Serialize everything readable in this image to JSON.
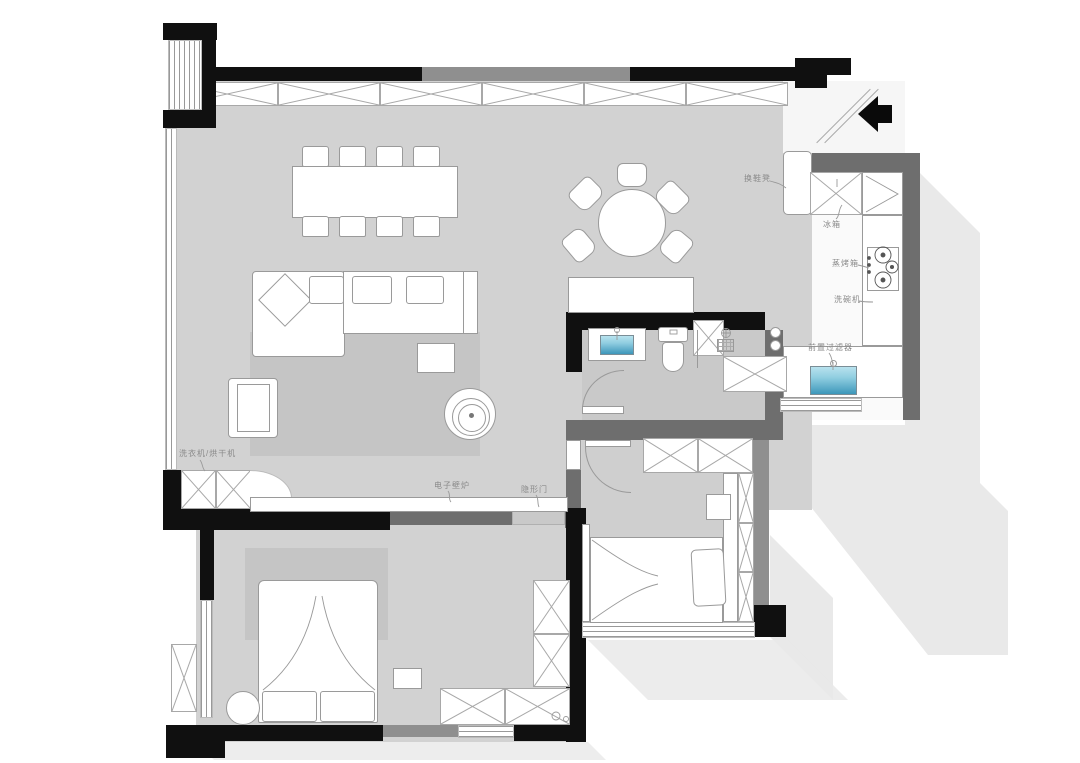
{
  "document": {
    "type": "apartment-floor-plan"
  },
  "colors": {
    "wall_black": "#101010",
    "wall_gray": "#6e6e6e",
    "wall_light_gray": "#8f8f8f",
    "floor_gray": "#d2d2d2",
    "bath_floor": "#c9c9c9",
    "bedroom2_upper_floor": "#cfcfcf",
    "bedroom2_lower_floor": "#f4f4f4",
    "rug": "#c5c5c5",
    "shadow": "#e9e9e9",
    "sink_blue_top": "#b8e2ee",
    "sink_blue_bottom": "#3d97ba",
    "hidden_door_panel": "#c9c9c9",
    "label_text": "#8a8a8a"
  },
  "labels": {
    "shoe_bench": "换鞋凳",
    "fridge": "冰箱",
    "steam_oven": "蒸烤箱",
    "dishwasher": "洗碗机",
    "pre_filter": "前置过滤器",
    "washer_dryer": "洗衣机/烘干机",
    "electric_fireplace": "电子壁炉",
    "hidden_door": "隐形门"
  },
  "annotations": {
    "entry_arrow_direction": "left"
  }
}
